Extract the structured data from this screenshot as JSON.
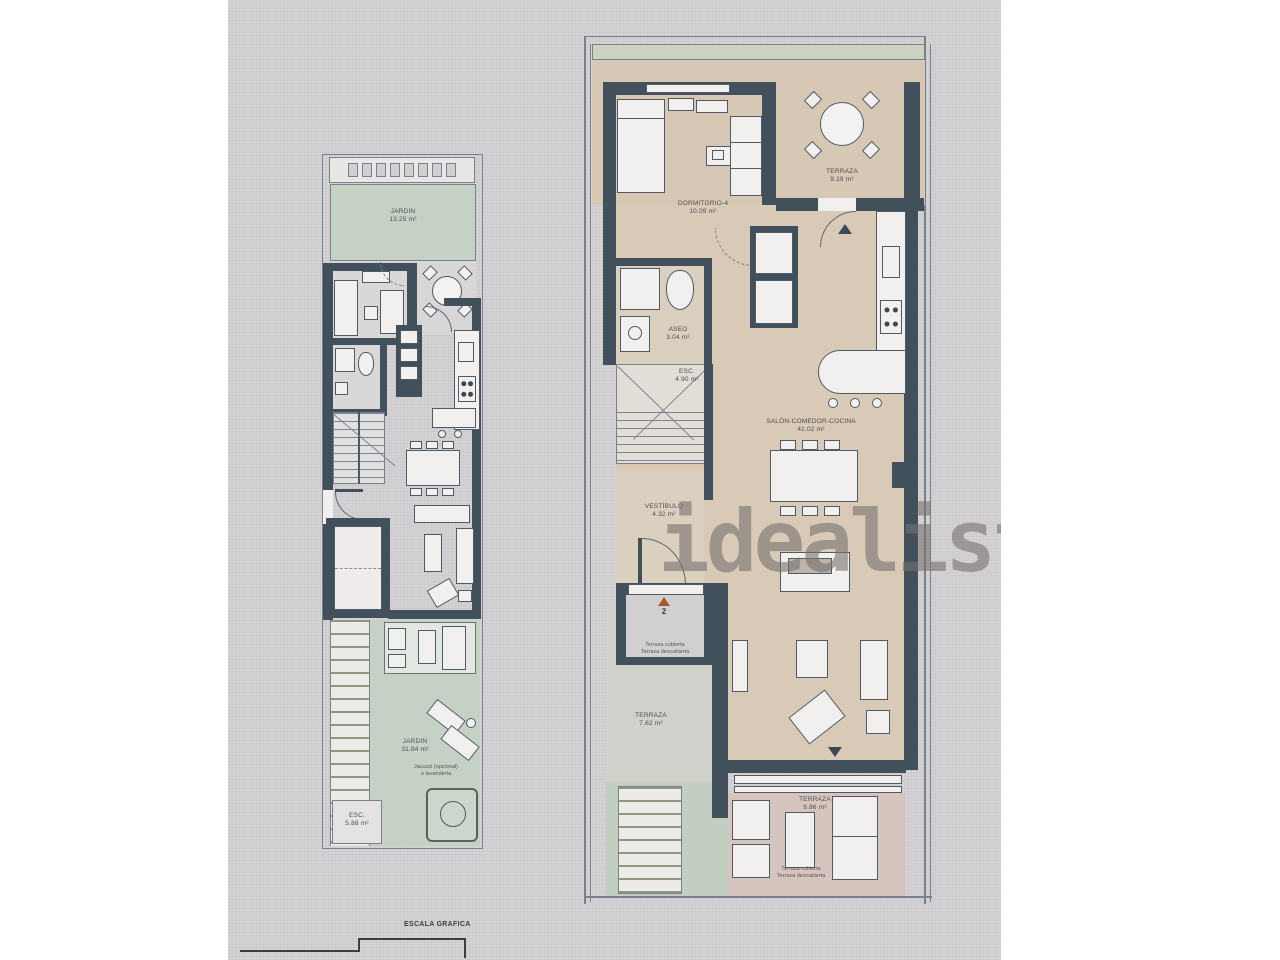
{
  "watermark": "idealista",
  "scale_bar": {
    "label": "ESCALA GRAFICA"
  },
  "colors": {
    "wall": "#42505c",
    "garden_green": "#c6d1c6",
    "hedge_green": "#ccd3c3",
    "interior_tan": "#d8cab7",
    "terrace_pink": "#d6c5be",
    "photo_background": "#d2cfd2",
    "watermark_gray": "#767270",
    "entry_marker_orange": "#9c5c2e"
  },
  "left_plan": {
    "jardin_top": {
      "name": "JARDIN",
      "area": "13.25 m²"
    },
    "jardin_bottom": {
      "name": "JARDIN",
      "area": "31.84 m²"
    },
    "jacuzzi_note": {
      "line1": "Jacuzzi (opcional)",
      "line2": "o lavandería"
    },
    "esc": {
      "name": "ESC.",
      "area": "5.88 m²"
    }
  },
  "right_plan": {
    "terraza_top": {
      "name": "TERRAZA",
      "area": "9.19 m²"
    },
    "dormitorio": {
      "name": "DORMITORIO-4",
      "area": "10.09 m²"
    },
    "aseo": {
      "name": "ASEO",
      "area": "3.04 m²"
    },
    "esc": {
      "name": "ESC.",
      "area": "4.90 m²"
    },
    "salon": {
      "name": "SALÓN-COMEDOR-COCINA",
      "area": "41.02 m²"
    },
    "vestibulo": {
      "name": "VESTÍBULO",
      "area": "4.32 m²"
    },
    "terraza_mid": {
      "name": "TERRAZA",
      "area": "7.62 m²"
    },
    "terraza_bottom": {
      "name": "TERRAZA",
      "area": "9.86 m²"
    },
    "entry_number": "2",
    "porch_note": {
      "line1": "Terraza cubierta",
      "line2": "Terraza descubierta"
    },
    "terrace_note": {
      "line1": "Terraza cubierta",
      "line2": "Terraza descubierta"
    }
  }
}
